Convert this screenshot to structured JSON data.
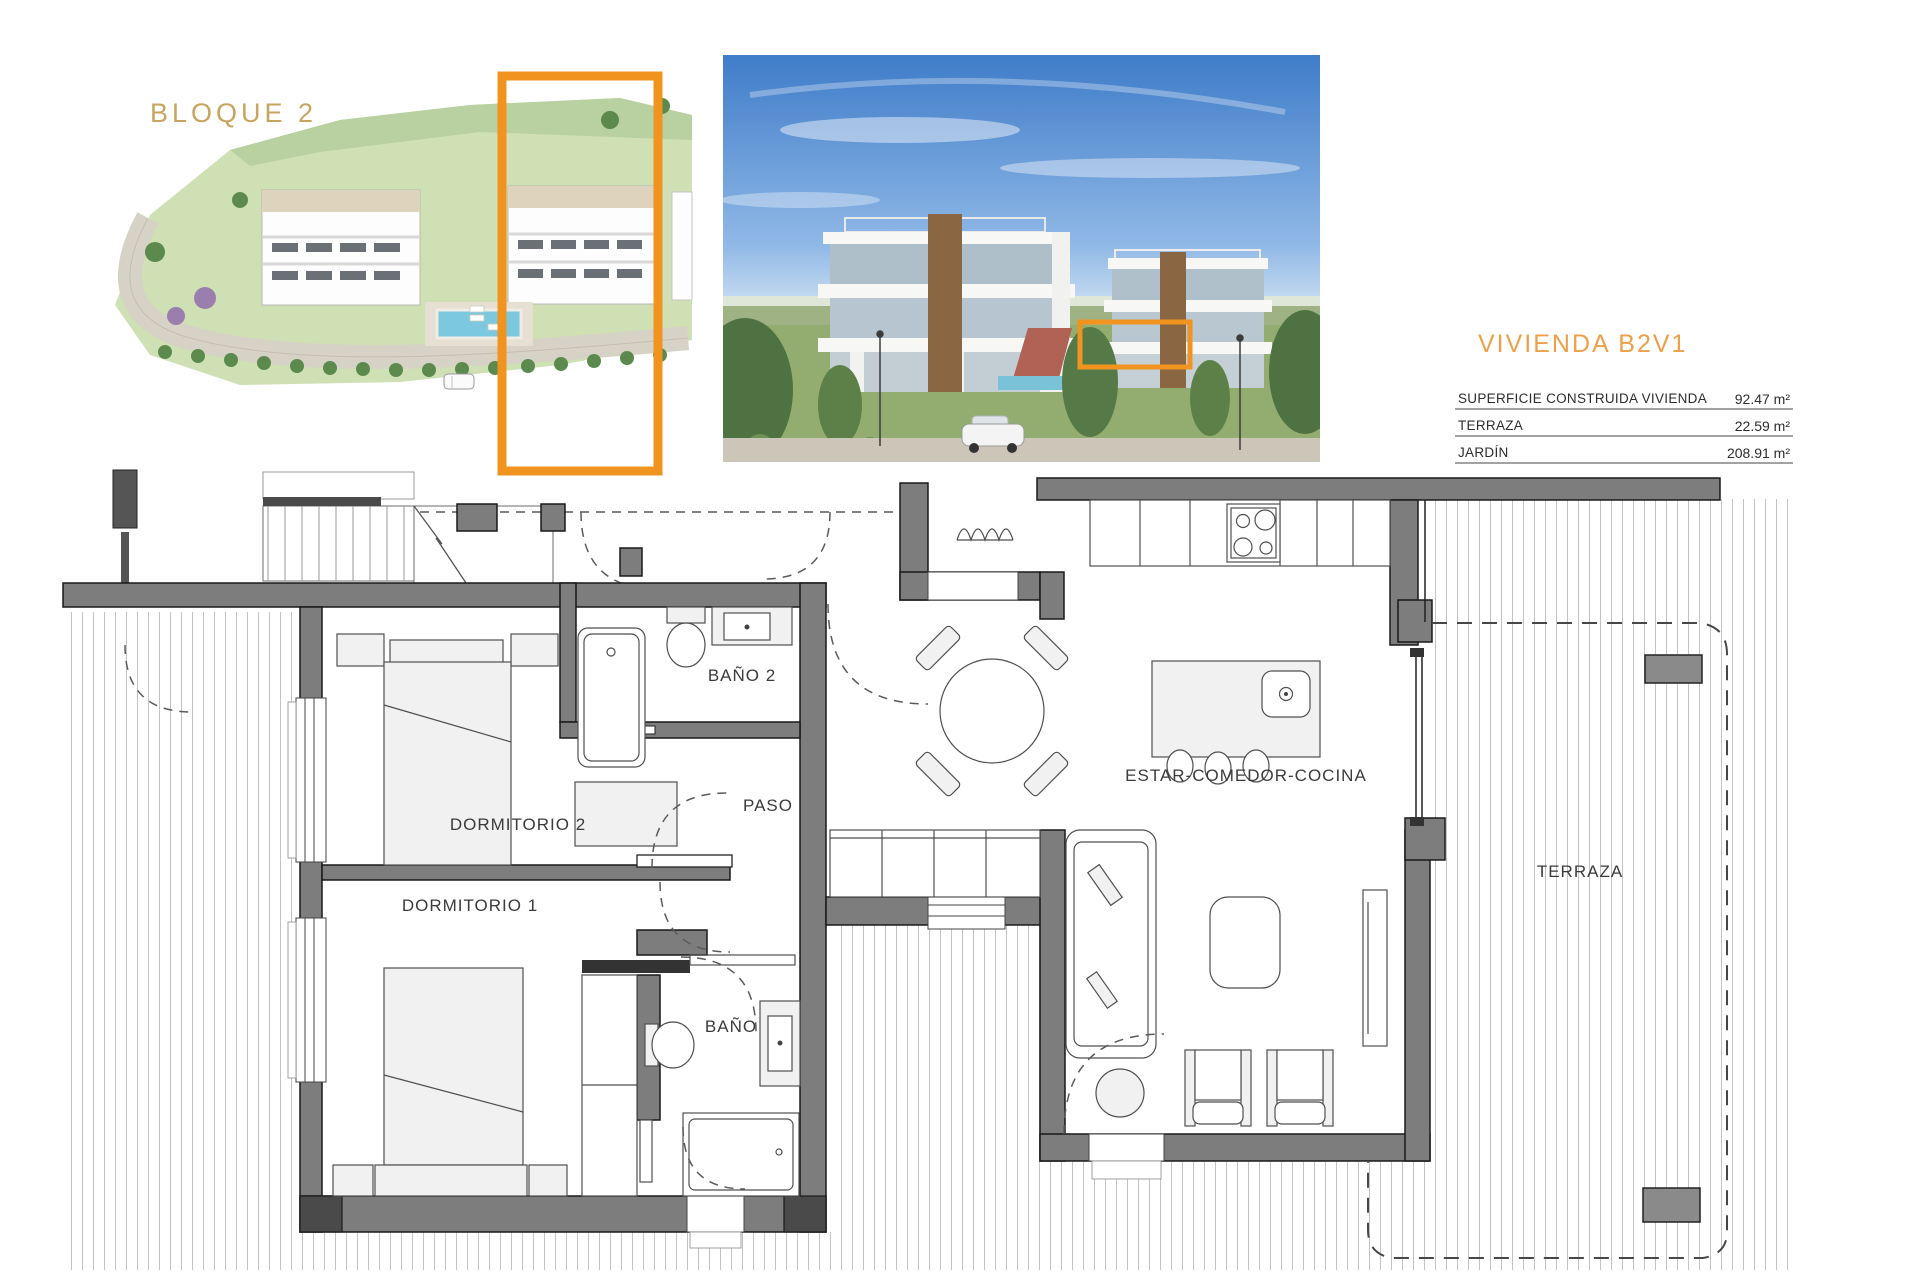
{
  "header": {
    "bloque_label": "BLOQUE 2",
    "unit_title": "VIVIENDA B2V1",
    "area_table": {
      "rows": [
        {
          "label": "SUPERFICIE CONSTRUIDA VIVIENDA",
          "value": "92.47 m²"
        },
        {
          "label": "TERRAZA",
          "value": "22.59 m²"
        },
        {
          "label": "JARDÍN",
          "value": "208.91 m²"
        }
      ]
    }
  },
  "plan": {
    "rooms": {
      "bano2": "BAÑO 2",
      "dormitorio2": "DORMITORIO 2",
      "paso": "PASO",
      "dormitorio1": "DORMITORIO 1",
      "bano": "BAÑO",
      "estar": "ESTAR-COMEDOR-COCINA",
      "terraza": "TERRAZA"
    }
  },
  "colors": {
    "highlight": "#F0941F",
    "title": "#EDA04A",
    "bloque": "#C8A55E",
    "wall": "#7d7d7d"
  }
}
